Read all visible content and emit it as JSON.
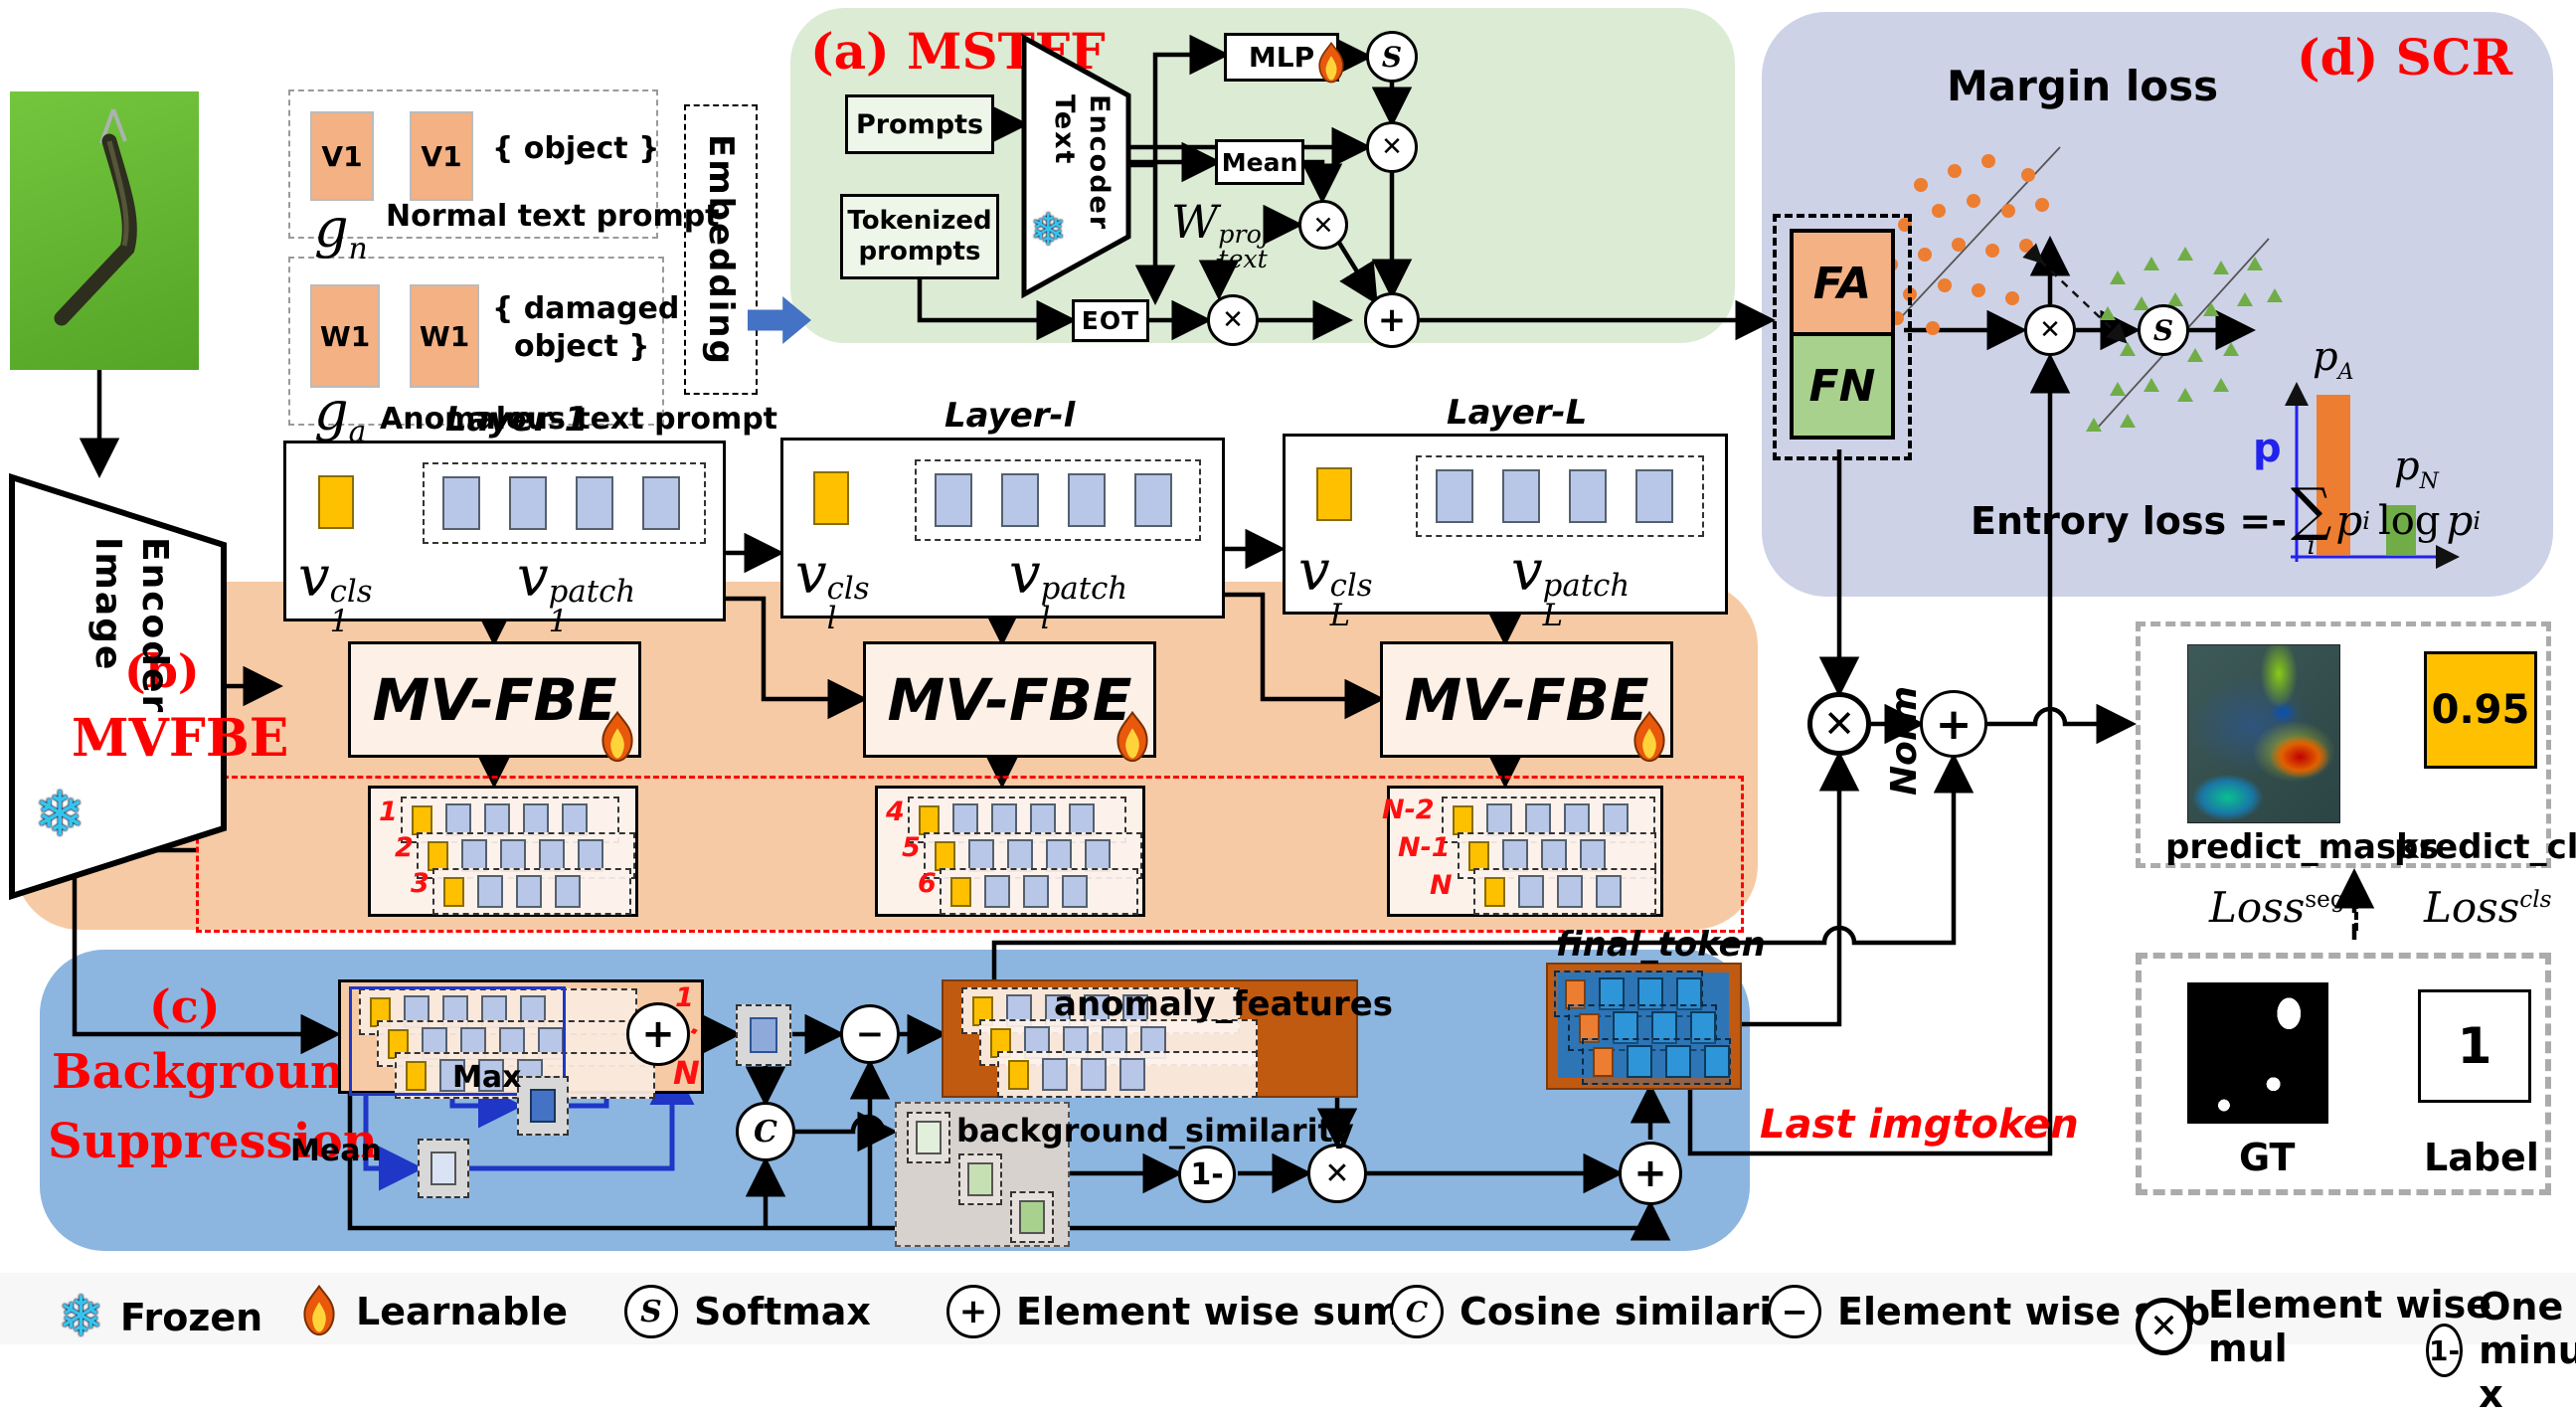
{
  "input": {
    "photo_alt": "query-image-green-hanger",
    "prompts": {
      "v1": "V1",
      "w1": "W1",
      "object_text": "{ object }",
      "damaged_l1": "{ damaged",
      "damaged_l2": "object }",
      "normal_caption": "Normal text prompt",
      "anomalous_caption": "Anomalous text prompt",
      "g": "g",
      "g_n_sub": "n",
      "g_a_sub": "a",
      "embedding": "Embedding"
    }
  },
  "image_encoder": {
    "l1": "Image",
    "l2": "Encoder"
  },
  "text_encoder": {
    "l1": "Text",
    "l2": "Encoder"
  },
  "ops": {
    "softmax": "S",
    "mul": "✕",
    "sum": "+",
    "cos": "C",
    "minus": "−",
    "one_minus": "1-"
  },
  "mstff": {
    "title": "(a) MSTFF",
    "prompts_box": "Prompts",
    "tokenized_l1": "Tokenized",
    "tokenized_l2": "prompts",
    "mlp": "MLP",
    "mean": "Mean",
    "eot": "EOT",
    "w": {
      "base": "W",
      "sub": "text",
      "sup": "proj"
    }
  },
  "layers": [
    {
      "title": "Layer-1",
      "v": "v",
      "sub": "1",
      "cls": "cls",
      "patch": "patch"
    },
    {
      "title": "Layer-l",
      "v": "v",
      "sub": "l",
      "cls": "cls",
      "patch": "patch"
    },
    {
      "title": "Layer-L",
      "v": "v",
      "sub": "L",
      "cls": "cls",
      "patch": "patch"
    }
  ],
  "mvfbe": {
    "badge": "(b)",
    "title": "MVFBE",
    "block": "MV-FBE",
    "s1": [
      "1",
      "2",
      "3"
    ],
    "s2": [
      "4",
      "5",
      "6"
    ],
    "s3": [
      "N-2",
      "N-1",
      "N"
    ]
  },
  "bs": {
    "badge": "(c)",
    "t1": "Background",
    "t2": "Suppression",
    "one": "1",
    "dots": "···",
    "n": "N",
    "max": "Max",
    "mean": "Mean",
    "anomaly": "anomaly_features",
    "bgsim": "background_similarity",
    "final": "final_token",
    "norm": "Norm",
    "last": "Last imgtoken"
  },
  "scr": {
    "title": "(d) SCR",
    "margin": "Margin loss",
    "fa": "FA",
    "fn": "FN",
    "p": "p",
    "pa": {
      "b": "p",
      "s": "A"
    },
    "pn": {
      "b": "p",
      "s": "N"
    },
    "entropy": {
      "prefix": "Entrory loss =-",
      "sigma": "∑",
      "isub": "i",
      "p1": "p",
      "s1": "i",
      "log": "log",
      "p2": "p",
      "s2": "i"
    }
  },
  "out": {
    "masks_label": "predict_masks",
    "cls_label": "predict_cls",
    "score": "0.95",
    "loss_seg": {
      "b": "Loss",
      "s": "seg"
    },
    "loss_cls": {
      "b": "Loss",
      "s": "cls"
    },
    "gt": "GT",
    "label": "Label",
    "one": "1"
  },
  "legend": [
    {
      "label": "Frozen"
    },
    {
      "label": "Learnable"
    },
    {
      "label": "Softmax"
    },
    {
      "label": "Element wise sum"
    },
    {
      "label": "Cosine similarity"
    },
    {
      "label": "Element wise sub"
    },
    {
      "label": "Element wise mul"
    },
    {
      "label": "One minus x"
    }
  ],
  "colors": {
    "mstff_bg": "#dcebd4",
    "scr_bg": "#cdd2e7",
    "mvfbe_bg": "#f6caa4",
    "bs_bg": "#8cb6e0",
    "orange_token": "#f4b183",
    "green_token": "#a9d18e",
    "cls_yellow": "#ffc000",
    "patch_blue": "#b8c7e8",
    "dark_orange": "#c05a11",
    "inner_blue": "#2e75b6",
    "accent_blue": "#4472c4",
    "red": "#fe0000"
  }
}
